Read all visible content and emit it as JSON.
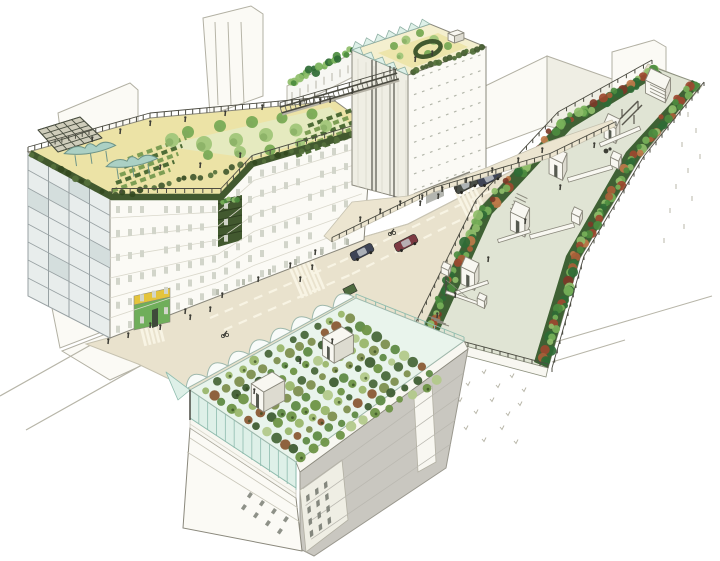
{
  "scene": {
    "illustration": "aerial perspective sketch of an urban block retrofit",
    "elements": [
      "l-shaped building with rooftop vegetable garden and canopies",
      "tower with rooftop garden and sawtooth skylights",
      "rooftop access bridge",
      "elevated linear park with planted borders, stair bulkheads and sheds",
      "street with cars, crosswalks and pedestrians",
      "podium terrace with railing",
      "building with rooftop greenhouse farm in crop rows",
      "background sketch buildings"
    ]
  },
  "palette": {
    "paper": "#ffffff",
    "line": "#6e6e64",
    "line_faint": "#b7b5a8",
    "facade_white": "#fbfaf5",
    "facade_shade": "#efeee4",
    "glass_blue": "#e8edec",
    "glass_cell": "#d2dcdc",
    "mullion": "#98a1a3",
    "wall_shadow": "#c9c7c0",
    "roof_paving": "#ece3a6",
    "paving_light": "#f4efcf",
    "hedge": "#42592f",
    "bed_green": "#4e6c36",
    "bed_green_light": "#7d9e54",
    "tree_green": "#a5c87d",
    "tree_green_dark": "#7fae5a",
    "canopy_teal": "#abd0c4",
    "canopy_edge": "#6d9488",
    "trellis_dark": "#4a4f41",
    "deck": "#e0e4d4",
    "border_base": "#3f6134",
    "border_greens": [
      "#4c8c3f",
      "#77b159",
      "#2f6b35",
      "#8fbe6a"
    ],
    "border_reds": [
      "#9c492f",
      "#7c3a28",
      "#bf7a4a",
      "#a86038"
    ],
    "street": "#e9e2cd",
    "plaza": "#ece5d0",
    "dash": "#f8f4e4",
    "car_navy": "#3e4456",
    "car_red": "#7d3a42",
    "car_dark": "#4a4f48",
    "car_green": "#4f6b3f",
    "greenhouse_glass": "#def0e8",
    "greenhouse_mullion": "#8fbcae",
    "greenhouse_floor": "#e9f4ec",
    "crop_colors": [
      "#9ab66b",
      "#4a683b",
      "#7e8f4f",
      "#8a5a35",
      "#5f8a45",
      "#3f5d33",
      "#b3c98b",
      "#6e9446"
    ],
    "structure_white": "#f8f7f1",
    "structure_shade": "#dddbd0",
    "railing_dark": "#4c4c42",
    "people_dark": "#3c3c35",
    "awning_yellow": "#e4c43c",
    "shop_green": "#6fae5a",
    "tick": "#b9b7aa"
  }
}
